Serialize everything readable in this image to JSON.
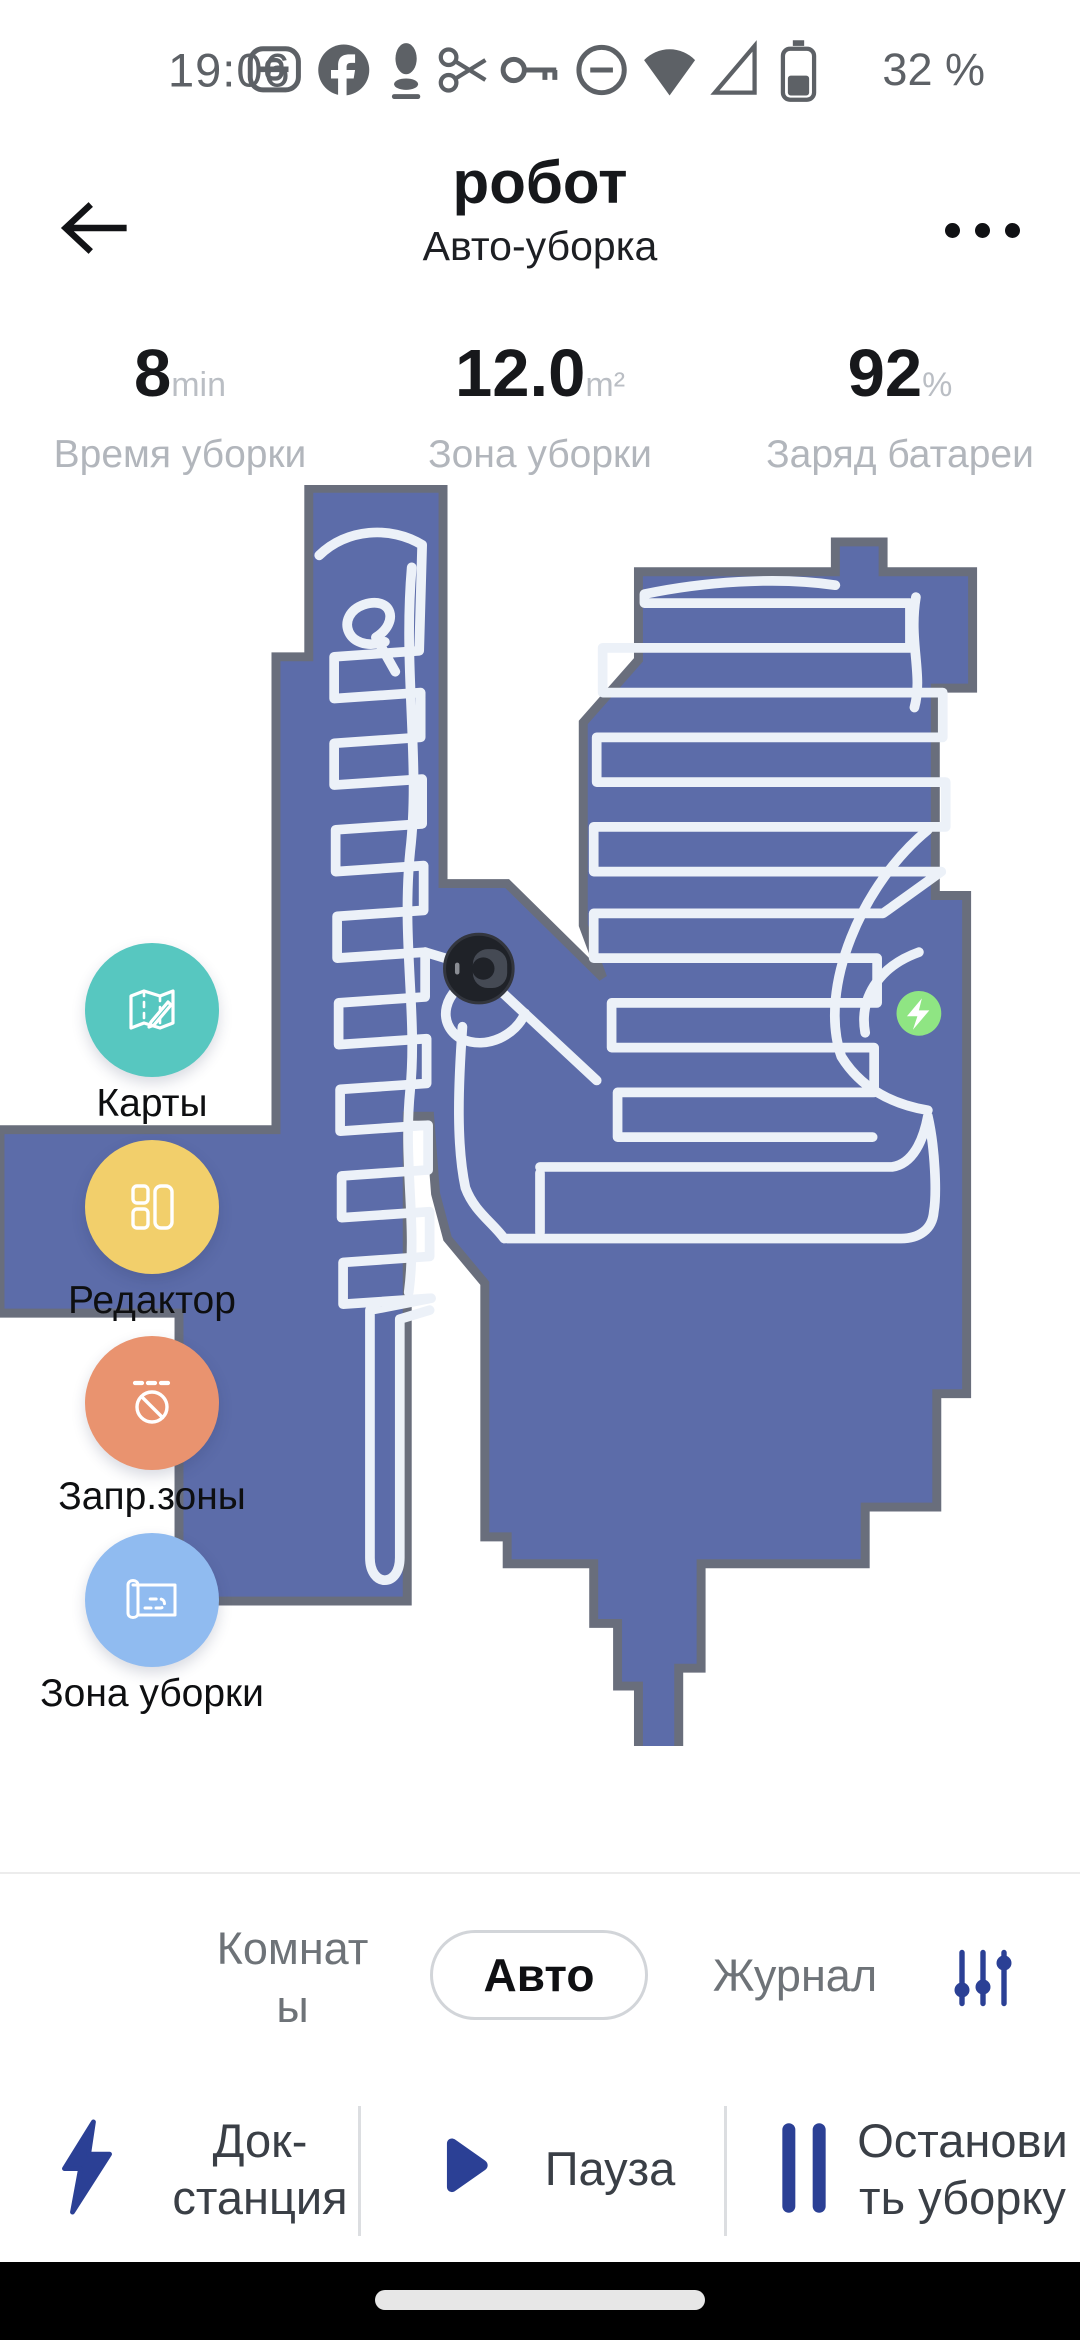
{
  "status_bar": {
    "time": "19:06",
    "battery_percent": "32 %",
    "icons": [
      "data-saver-icon",
      "facebook-icon",
      "assistant-icon",
      "scissors-icon",
      "key-icon",
      "do-not-disturb-icon",
      "wifi-icon",
      "cell-signal-icon",
      "battery-icon"
    ]
  },
  "header": {
    "title": "робот",
    "subtitle": "Авто-уборка"
  },
  "stats": {
    "items": [
      {
        "value": "8",
        "unit": "min",
        "label": "Время уборки"
      },
      {
        "value": "12.0",
        "unit": "m²",
        "label": "Зона уборки"
      },
      {
        "value": "92",
        "unit": "%",
        "label": "Заряд батареи"
      }
    ]
  },
  "map": {
    "colors": {
      "floor": "#5C6CA9",
      "wall": "#696E7C",
      "path": "#ECF1F8",
      "dock": "#8FE583",
      "robot": "#1F2228"
    },
    "buttons": [
      {
        "label": "Карты",
        "color": "#57C7C0",
        "icon": "map-icon"
      },
      {
        "label": "Редактор",
        "color": "#F2CF6B",
        "icon": "layout-icon"
      },
      {
        "label": "Запр.зоны",
        "color": "#E9936F",
        "icon": "no-entry-icon"
      },
      {
        "label": "Зона уборки",
        "color": "#90BBF0",
        "icon": "blueprint-icon"
      }
    ],
    "markers": {
      "robot": "robot-marker",
      "dock": "dock-marker"
    }
  },
  "tabs": {
    "items": [
      {
        "label": "Комнаты",
        "lines": [
          "Комнат",
          "ы"
        ],
        "selected": false
      },
      {
        "label": "Авто",
        "selected": true
      },
      {
        "label": "Журнал",
        "selected": false
      }
    ],
    "filter_icon": "sliders-icon"
  },
  "actions": {
    "items": [
      {
        "icon": "lightning-icon",
        "lines": [
          "Док-",
          "станция"
        ]
      },
      {
        "icon": "play-icon",
        "lines": [
          "Пауза"
        ]
      },
      {
        "icon": "pause-icon",
        "lines": [
          "Останови",
          "ть уборку"
        ]
      }
    ]
  },
  "nav": {
    "handle": "gesture-bar"
  }
}
